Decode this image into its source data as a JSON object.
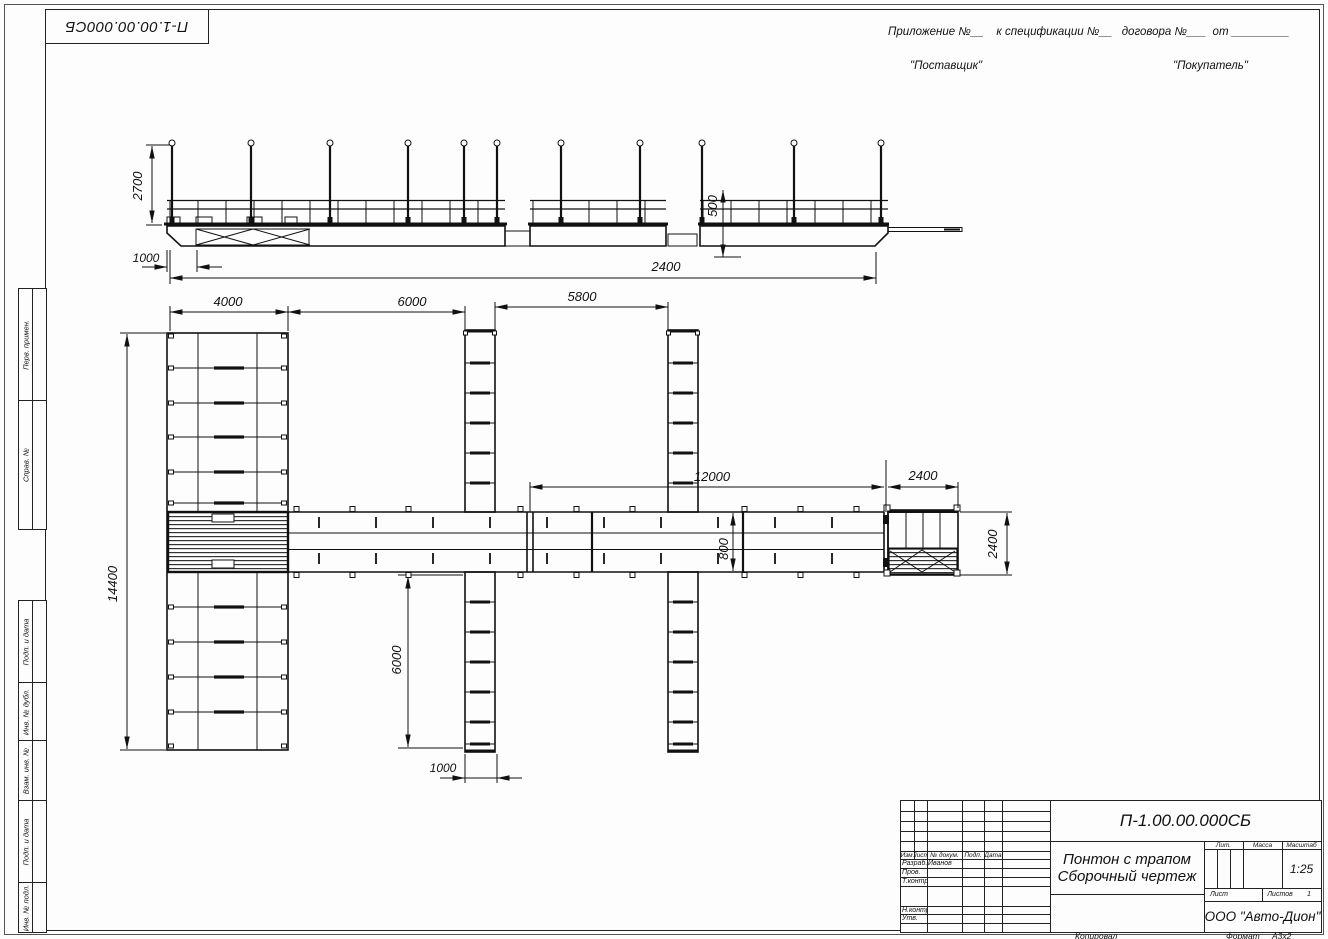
{
  "sheet": {
    "corner_designation": "П-1.00.00.000СБ",
    "appendix_line": "Приложение №__    к спецификации №__   договора №___  от _________",
    "supplier": "\"Поставщик\"",
    "buyer": "\"Покупатель\"",
    "copied": "Копировал",
    "format_label": "Формат",
    "format_value": "А3х2"
  },
  "margin": {
    "labels": [
      "Перв. примен.",
      "Справ. №",
      "Подп. и дата",
      "Инв. № дубл.",
      "Взам. инв. №",
      "Подп. и дата",
      "Инв. № подл."
    ]
  },
  "title_block": {
    "designation": "П-1.00.00.000СБ",
    "title_line1": "Понтон с трапом",
    "title_line2": "Сборочный чертеж",
    "col_izm": "Изм.",
    "col_list": "Лист",
    "col_docnum": "№ докум.",
    "col_podp": "Подп.",
    "col_data": "Дата",
    "row_razrab": "Разраб.",
    "razrab_name": "Иванов",
    "row_prov": "Пров.",
    "row_tkontr": "Т.контр.",
    "row_nkontr": "Н.контр.",
    "row_utv": "Утв.",
    "lit": "Лит.",
    "massa": "Масса",
    "masshtab": "Масштаб",
    "scale": "1:25",
    "list_label": "Лист",
    "listov_label": "Листов",
    "listov_value": "1",
    "company": "ООО \"Авто-Дион\""
  },
  "dims": {
    "elev_height": "2700",
    "elev_offset": "1000",
    "elev_freeboard": "500",
    "elev_length": "2400",
    "plan_left_w": "4000",
    "plan_gap": "6000",
    "plan_span": "5800",
    "plan_walk": "12000",
    "plan_ramp_w": "2400",
    "plan_left_len": "14400",
    "plan_walk_w": "800",
    "plan_finger_len": "6000",
    "plan_finger_w": "1000",
    "plan_ramp_h": "2400"
  }
}
